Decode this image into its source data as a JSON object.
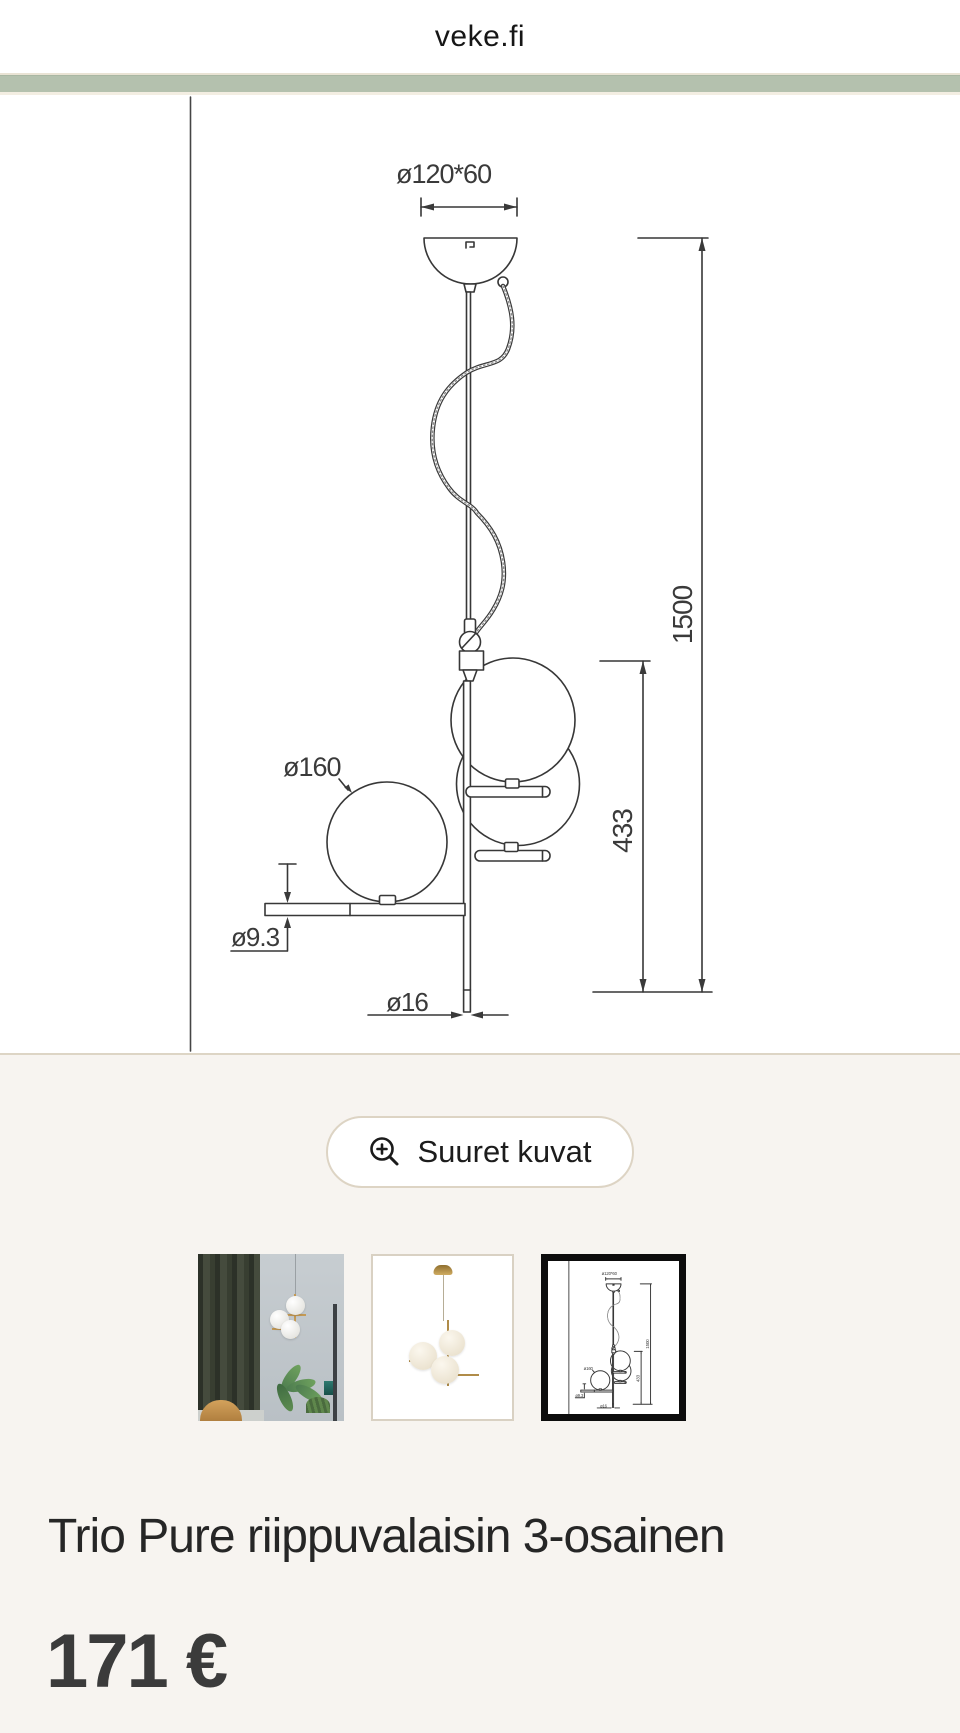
{
  "header": {
    "brand": "veke.fi"
  },
  "drawing": {
    "dim_canopy": "ø120*60",
    "dim_total_height": "1500",
    "dim_fixture_height": "433",
    "dim_globe": "ø160",
    "dim_arm": "ø9.3",
    "dim_rod": "ø16"
  },
  "gallery": {
    "zoom_button_label": "Suuret kuvat",
    "zoom_icon": "zoom-in-icon",
    "thumbnails": [
      {
        "name": "lifestyle-photo",
        "selected": false
      },
      {
        "name": "product-photo",
        "selected": false
      },
      {
        "name": "technical-drawing",
        "selected": true
      }
    ]
  },
  "product": {
    "title": "Trio Pure riippuvalaisin 3-osainen",
    "price": "171 €"
  },
  "colors": {
    "accent_bar": "#b4c1ae",
    "hairline": "#ddd5c5",
    "page_bg": "#f7f4f0",
    "selected_thumb_border": "#0d0d0d",
    "drawing_line": "#3a3a3a"
  }
}
